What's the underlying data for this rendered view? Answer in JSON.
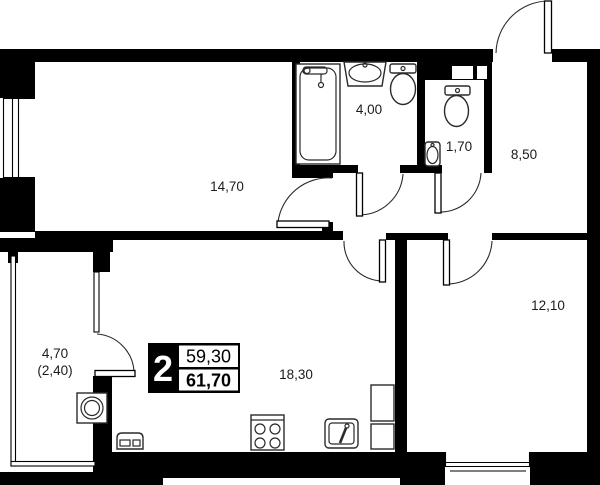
{
  "plan": {
    "title": "apartment-floor-plan",
    "apartment_badge": {
      "rooms_count": "2",
      "living_area": "59,30",
      "total_area": "61,70"
    },
    "rooms": [
      {
        "id": "room-1",
        "area": "14,70"
      },
      {
        "id": "bathroom",
        "area": "4,00"
      },
      {
        "id": "wc",
        "area": "1,70"
      },
      {
        "id": "hallway",
        "area": "8,50"
      },
      {
        "id": "bedroom",
        "area": "12,10"
      },
      {
        "id": "living-kitchen",
        "area": "18,30"
      },
      {
        "id": "balcony",
        "area": "4,70",
        "area_reduced": "(2,40)"
      }
    ],
    "colors": {
      "wall": "#000000",
      "background": "#ffffff",
      "label_text": "#1b1b1b",
      "badge_bg": "#000000",
      "badge_text": "#ffffff"
    }
  }
}
